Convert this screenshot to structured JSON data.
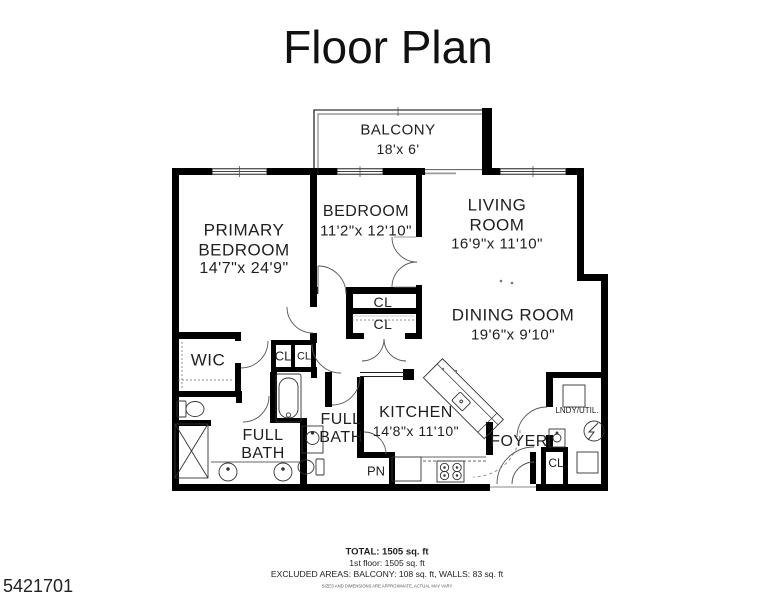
{
  "title": "Floor Plan",
  "plan": {
    "balcony": {
      "name": "BALCONY",
      "dims": "18'x 6'"
    },
    "primary_bedroom": {
      "line1": "PRIMARY",
      "line2": "BEDROOM",
      "dims": "14'7\"x 24'9\""
    },
    "bedroom": {
      "name": "BEDROOM",
      "dims": "11'2\"x 12'10\""
    },
    "living_room": {
      "line1": "LIVING",
      "line2": "ROOM",
      "dims": "16'9\"x 11'10\""
    },
    "dining_room": {
      "name": "DINING ROOM",
      "dims": "19'6\"x 9'10\""
    },
    "kitchen": {
      "name": "KITCHEN",
      "dims": "14'8\"x 11'10\""
    },
    "wic": {
      "name": "WIC"
    },
    "closet_upper": {
      "name": "CL"
    },
    "closet_lower": {
      "name": "CL"
    },
    "hall_closet_left": {
      "name": "CL"
    },
    "hall_closet_right": {
      "name": "CL"
    },
    "full_bath_primary": {
      "line1": "FULL",
      "line2": "BATH"
    },
    "full_bath_hall": {
      "line1": "FULL",
      "line2": "BATH"
    },
    "pantry": {
      "name": "PN"
    },
    "foyer": {
      "name": "FOYER"
    },
    "laundry": {
      "name": "LNDY/UTIL."
    },
    "laundry_closet": {
      "name": "CL"
    }
  },
  "footer": {
    "total": "TOTAL: 1505 sq. ft",
    "first_floor": "1st floor: 1505 sq. ft",
    "excluded": "EXCLUDED AREAS: BALCONY: 108 sq. ft, WALLS: 83 sq. ft",
    "disclaimer": "SIZES AND DIMENSIONS ARE APPROXIMATE, ACTUAL MAY VARY"
  },
  "watermark_id": "5421701",
  "colors": {
    "wall": "#000000",
    "fixture": "#333333",
    "door_arc": "#555555"
  }
}
